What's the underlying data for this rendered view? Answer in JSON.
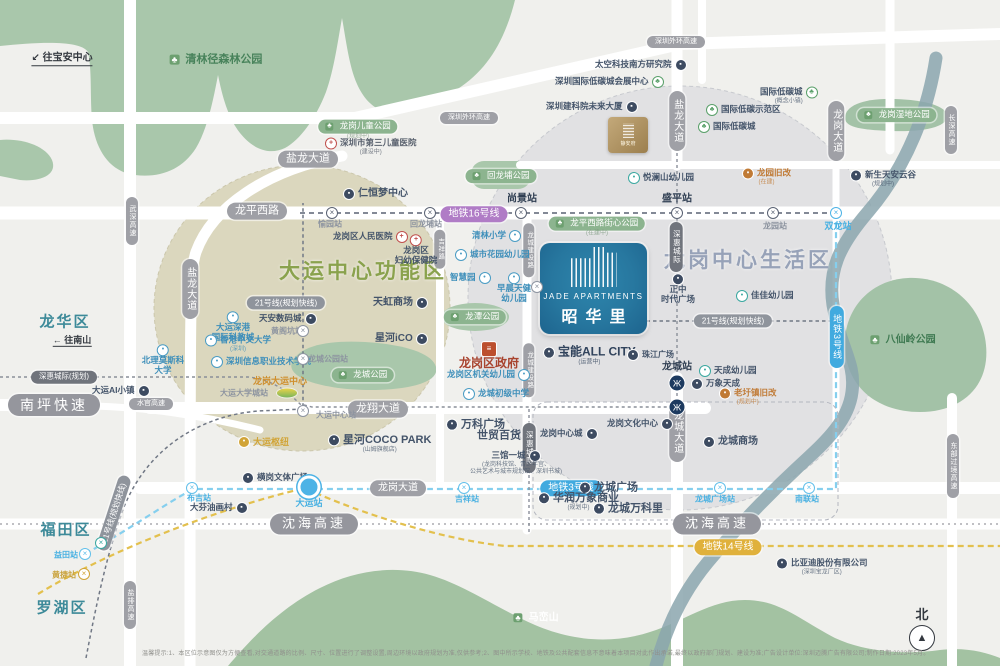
{
  "project": {
    "en": "JADE APARTMENTS",
    "cn": "昭华里",
    "sister": "静安府"
  },
  "compass": {
    "label": "北"
  },
  "disclaimer": {
    "text": "温馨提示:1、本区位示意图仅为方便查看,对交通道路的比例、尺寸、位置进行了调整设置,周边环境以政府规划为准,仅供参考;2、图中所示学校、地铁及公共配套信息不意味着本项目对此作出承诺,最终以政府部门规划、建设为准;广告设计单位:深圳迈腾广告有限公司;制作日期:2023年5月。"
  },
  "zones": [
    {
      "t": "大运中心功能区",
      "x": 363,
      "y": 272,
      "c": "#8aa24d",
      "fs": 21
    },
    {
      "t": "龙岗中心生活区",
      "x": 748,
      "y": 261,
      "c": "#97a2b8",
      "fs": 21
    }
  ],
  "districts": [
    {
      "t": "龙华区",
      "x": 65,
      "y": 322,
      "fs": 15
    },
    {
      "t": "福田区",
      "x": 66,
      "y": 530,
      "fs": 15
    },
    {
      "t": "罗湖区",
      "x": 62,
      "y": 608,
      "fs": 15
    }
  ],
  "arrows": [
    {
      "t": "↙ 往宝安中心",
      "x": 62,
      "y": 59,
      "fs": 10
    },
    {
      "t": "← 往南山",
      "x": 72,
      "y": 341,
      "fs": 9
    }
  ],
  "road_badges": [
    {
      "t": "盐龙大道",
      "x": 308,
      "y": 159,
      "fs": 11
    },
    {
      "t": "龙平西路",
      "x": 257,
      "y": 211,
      "fs": 11
    },
    {
      "t": "深圳外环高速",
      "x": 469,
      "y": 118,
      "fs": 7
    },
    {
      "t": "深圳外环高速",
      "x": 676,
      "y": 42,
      "fs": 7
    },
    {
      "t": "龙翔大道",
      "x": 378,
      "y": 409,
      "fs": 11
    },
    {
      "t": "龙岗大道",
      "x": 398,
      "y": 488,
      "fs": 10
    },
    {
      "t": "南坪快速",
      "x": 54,
      "y": 405,
      "fs": 14,
      "big": 1
    },
    {
      "t": "水官高速",
      "x": 151,
      "y": 404,
      "fs": 7
    },
    {
      "t": "沈海高速",
      "x": 314,
      "y": 524,
      "fs": 13,
      "big": 1
    },
    {
      "t": "沈海高速",
      "x": 717,
      "y": 524,
      "fs": 13,
      "big": 1
    },
    {
      "t": "武深高速",
      "x": 132,
      "y": 221,
      "fs": 7,
      "vert": 1
    },
    {
      "t": "盐龙大道",
      "x": 190,
      "y": 289,
      "fs": 10,
      "vert": 1
    },
    {
      "t": "盐龙大道",
      "x": 677,
      "y": 121,
      "fs": 10,
      "vert": 1
    },
    {
      "t": "龙岗大道",
      "x": 836,
      "y": 131,
      "fs": 10,
      "vert": 1
    },
    {
      "t": "长深高速",
      "x": 951,
      "y": 130,
      "fs": 7,
      "vert": 1
    },
    {
      "t": "盐排高速",
      "x": 130,
      "y": 605,
      "fs": 7,
      "vert": 1
    },
    {
      "t": "东部过境高速",
      "x": 953,
      "y": 466,
      "fs": 7,
      "vert": 1
    },
    {
      "t": "龙城大道",
      "x": 677,
      "y": 432,
      "fs": 10,
      "vert": 1
    },
    {
      "t": "龙城建设路",
      "x": 529,
      "y": 250,
      "fs": 6.5,
      "vert": 1
    },
    {
      "t": "龙城建设路",
      "x": 529,
      "y": 370,
      "fs": 6.5,
      "vert": 1
    },
    {
      "t": "吉祥路",
      "x": 440,
      "y": 249,
      "fs": 6.5,
      "vert": 1
    }
  ],
  "metro_badges": [
    {
      "t": "地铁16号线",
      "x": 474,
      "y": 214,
      "bg": "#b07cc6",
      "fs": 10
    },
    {
      "t": "地铁3号线",
      "x": 571,
      "y": 488,
      "bg": "#41aadf",
      "fs": 10
    },
    {
      "t": "地铁3号线",
      "x": 837,
      "y": 337,
      "bg": "#41aadf",
      "fs": 9,
      "vert": 1
    },
    {
      "t": "地铁14号线",
      "x": 728,
      "y": 547,
      "bg": "#e0b13c",
      "fs": 10
    },
    {
      "t": "21号线(规划快线)",
      "x": 286,
      "y": 303,
      "bg": "#8f949c",
      "fs": 8
    },
    {
      "t": "21号线(规划快线)",
      "x": 733,
      "y": 321,
      "bg": "#8f949c",
      "fs": 8
    },
    {
      "t": "21号线(规划快线)",
      "x": 114,
      "y": 513,
      "bg": "#8f949c",
      "fs": 8,
      "rot": -72
    },
    {
      "t": "深惠城际(规划)",
      "x": 64,
      "y": 377,
      "bg": "#70747c",
      "fs": 7.5
    },
    {
      "t": "深惠城际",
      "x": 676,
      "y": 247,
      "bg": "#70747c",
      "fs": 7.5,
      "vert": 1
    },
    {
      "t": "深惠城际",
      "x": 529,
      "y": 448,
      "bg": "#70747c",
      "fs": 7.5,
      "vert": 1
    }
  ],
  "park_pills": [
    {
      "t": "龙岗儿童公园",
      "x": 358,
      "y": 130,
      "sub": "(规划中)"
    },
    {
      "t": "回龙埔公园",
      "x": 501,
      "y": 176
    },
    {
      "t": "龙平西路街心公园",
      "x": 597,
      "y": 227,
      "sub": "(在建中)"
    },
    {
      "t": "龙潭公园",
      "x": 475,
      "y": 317
    },
    {
      "t": "龙城公园",
      "x": 363,
      "y": 375
    },
    {
      "t": "龙岗湿地公园",
      "x": 897,
      "y": 115
    }
  ],
  "park_texts": [
    {
      "t": "清林径森林公园",
      "x": 216,
      "y": 60,
      "c": "#47825a",
      "fs": 11
    },
    {
      "t": "八仙岭公园",
      "x": 903,
      "y": 340,
      "c": "#3f7a52",
      "fs": 10
    },
    {
      "t": "马峦山",
      "x": 536,
      "y": 618,
      "c": "#ffffff",
      "fs": 10
    }
  ],
  "pois": [
    {
      "t": "太空科技南方研究院",
      "x": 595,
      "y": 65,
      "ic": "biz",
      "side": "r"
    },
    {
      "t": "深圳国际低碳城会展中心",
      "x": 555,
      "y": 82,
      "ic": "eco",
      "side": "r"
    },
    {
      "t": "深圳建科院未来大厦",
      "x": 546,
      "y": 107,
      "ic": "biz",
      "side": "r"
    },
    {
      "t": "国际低碳城",
      "x": 760,
      "y": 96,
      "ic": "eco",
      "side": "r",
      "sub": "(概念小镇)"
    },
    {
      "t": "国际低碳示范区",
      "x": 706,
      "y": 110,
      "ic": "eco"
    },
    {
      "t": "国际低碳城",
      "x": 698,
      "y": 127,
      "ic": "eco"
    },
    {
      "t": "新生天安云谷",
      "x": 850,
      "y": 179,
      "ic": "biz",
      "sub": "(规划中)"
    },
    {
      "t": "悦澜山幼儿园",
      "x": 628,
      "y": 178,
      "ic": "kid"
    },
    {
      "t": "龙园旧改",
      "x": 742,
      "y": 177,
      "ic": "org",
      "c": "#c07a35",
      "sub": "(在建)"
    },
    {
      "t": "仁恒梦中心",
      "x": 343,
      "y": 194,
      "ic": "biz",
      "fs": 10
    },
    {
      "t": "深圳市第三儿童医院",
      "x": 325,
      "y": 147,
      "ic": "red",
      "c": "#59616e",
      "sub": "(建设中)"
    },
    {
      "t": "龙岗区人民医院",
      "x": 333,
      "y": 237,
      "ic": "red",
      "side": "r"
    },
    {
      "t": "龙岗区妇幼保健院",
      "x": 416,
      "y": 250,
      "ic": "red",
      "stack": [
        "龙岗区",
        "妇幼保健院"
      ]
    },
    {
      "t": "清林小学",
      "x": 472,
      "y": 236,
      "ic": "edu",
      "side": "r",
      "c": "#3e8fba"
    },
    {
      "t": "城市花园幼儿园",
      "x": 455,
      "y": 255,
      "ic": "edu",
      "c": "#3e8fba"
    },
    {
      "t": "智慧园",
      "x": 450,
      "y": 278,
      "ic": "edu",
      "side": "r",
      "c": "#3e8fba"
    },
    {
      "t": "早晨天健幼儿园",
      "x": 514,
      "y": 288,
      "ic": "edu",
      "c": "#3e8fba",
      "stack": [
        "早晨天健",
        "幼儿园"
      ]
    },
    {
      "t": "天虹商场",
      "x": 373,
      "y": 303,
      "ic": "biz",
      "side": "r",
      "fs": 10
    },
    {
      "t": "星河iCO",
      "x": 375,
      "y": 339,
      "ic": "biz",
      "side": "r",
      "fs": 10
    },
    {
      "t": "龙岗区政府",
      "x": 489,
      "y": 356,
      "ic": "gov",
      "c": "#a8432e",
      "fs": 12,
      "fw": 700,
      "stack": [
        "龙岗区政府"
      ]
    },
    {
      "t": "龙岗区机关幼儿园",
      "x": 447,
      "y": 375,
      "ic": "edu",
      "side": "r",
      "c": "#3e8fba"
    },
    {
      "t": "龙城初级中学",
      "x": 463,
      "y": 394,
      "ic": "edu",
      "c": "#3e8fba"
    },
    {
      "t": "大运深港国际科教城",
      "x": 233,
      "y": 327,
      "ic": "edu",
      "c": "#3e8fba",
      "stack": [
        "大运深港",
        "国际科教城"
      ]
    },
    {
      "t": "天安数码城",
      "x": 259,
      "y": 319,
      "ic": "biz",
      "side": "r"
    },
    {
      "t": "香港中文大学",
      "x": 205,
      "y": 344,
      "ic": "edu",
      "c": "#3e8fba",
      "sub": "(深圳)"
    },
    {
      "t": "深圳信息职业技术学院",
      "x": 211,
      "y": 362,
      "ic": "edu",
      "c": "#3e8fba"
    },
    {
      "t": "北理莫斯科大学",
      "x": 163,
      "y": 360,
      "ic": "edu",
      "c": "#3e8fba",
      "stack": [
        "北理莫斯科",
        "大学"
      ]
    },
    {
      "t": "龙岗大运中心",
      "x": 253,
      "y": 381,
      "c": "#cf8f2e",
      "fs": 9,
      "fw": 700
    },
    {
      "t": "大运AI小镇",
      "x": 92,
      "y": 391,
      "ic": "biz",
      "side": "r"
    },
    {
      "t": "大运枢纽",
      "x": 238,
      "y": 442,
      "ic": "gold",
      "c": "#d1a437",
      "fs": 9,
      "fw": 700
    },
    {
      "t": "横岗文体广场",
      "x": 242,
      "y": 478,
      "ic": "biz"
    },
    {
      "t": "大芬油画村",
      "x": 190,
      "y": 508,
      "ic": "biz",
      "side": "r"
    },
    {
      "t": "星河COCO PARK",
      "x": 328,
      "y": 444,
      "ic": "biz",
      "fs": 11,
      "fw": 700,
      "sub": "(山姆旗舰店)"
    },
    {
      "t": "万科广场",
      "x": 446,
      "y": 425,
      "ic": "biz",
      "fs": 11,
      "fw": 700
    },
    {
      "t": "世贸百货",
      "x": 477,
      "y": 436,
      "fs": 11,
      "fw": 700
    },
    {
      "t": "三馆一城",
      "x": 470,
      "y": 463,
      "ic": "biz",
      "side": "r",
      "sub": "(龙岗科技馆、青少年宫、",
      "sub2": "公共艺术与城市规划馆、深圳书城)"
    },
    {
      "t": "宝能ALL CITY",
      "x": 543,
      "y": 356,
      "ic": "biz",
      "fs": 12,
      "fw": 700,
      "c": "#31435c",
      "sub": "(运营中)"
    },
    {
      "t": "珠江广场",
      "x": 627,
      "y": 355,
      "ic": "biz",
      "fs": 8
    },
    {
      "t": "正中时代广场",
      "x": 678,
      "y": 289,
      "ic": "biz",
      "stack": [
        "正中",
        "时代广场"
      ]
    },
    {
      "t": "佳佳幼儿园",
      "x": 736,
      "y": 296,
      "ic": "kid"
    },
    {
      "t": "天成幼儿园",
      "x": 699,
      "y": 371,
      "ic": "kid"
    },
    {
      "t": "万象天成",
      "x": 691,
      "y": 384,
      "ic": "biz"
    },
    {
      "t": "老圩镇旧改",
      "x": 719,
      "y": 397,
      "ic": "org",
      "c": "#c07a35",
      "sub": "(规划中)"
    },
    {
      "t": "龙岗中心城",
      "x": 540,
      "y": 434,
      "ic": "biz",
      "side": "r"
    },
    {
      "t": "龙城广场",
      "x": 579,
      "y": 488,
      "ic": "biz",
      "fs": 11,
      "fw": 700
    },
    {
      "t": "龙城万科里",
      "x": 593,
      "y": 509,
      "ic": "biz",
      "fs": 11,
      "fw": 700
    },
    {
      "t": "华润万象商业",
      "x": 538,
      "y": 502,
      "ic": "biz",
      "fs": 11,
      "fw": 700,
      "sub": "(规划中)"
    },
    {
      "t": "龙岗文化中心",
      "x": 607,
      "y": 424,
      "ic": "biz",
      "side": "r"
    },
    {
      "t": "龙城商场",
      "x": 703,
      "y": 442,
      "ic": "biz",
      "fs": 10,
      "fw": 700
    },
    {
      "t": "比亚迪股份有限公司",
      "x": 776,
      "y": 567,
      "ic": "biz",
      "sub": "(深圳宝龙厂区)"
    }
  ],
  "stations": [
    {
      "t": "尚景站",
      "x": 522,
      "y": 199,
      "c": "#2f3e52",
      "fw": 700,
      "fs": 10
    },
    {
      "t": "盛平站",
      "x": 677,
      "y": 199,
      "c": "#2f3e52",
      "fw": 700,
      "fs": 10
    },
    {
      "t": "龙城站",
      "x": 677,
      "y": 367,
      "c": "#2f3e52",
      "fw": 700,
      "fs": 10
    },
    {
      "t": "回龙埔站",
      "x": 426,
      "y": 224,
      "c": "#8d94a0",
      "fs": 8
    },
    {
      "t": "愉园站",
      "x": 330,
      "y": 224,
      "c": "#8d94a0",
      "fs": 8
    },
    {
      "t": "龙园站",
      "x": 775,
      "y": 226,
      "c": "#8d94a0",
      "fs": 8
    },
    {
      "t": "双龙站",
      "x": 838,
      "y": 226,
      "c": "#49b1e2",
      "fs": 9
    },
    {
      "t": "布吉站",
      "x": 199,
      "y": 498,
      "c": "#49b1e2",
      "fs": 8
    },
    {
      "t": "大运站",
      "x": 309,
      "y": 503,
      "c": "#49b1e2",
      "fs": 9
    },
    {
      "t": "吉祥站",
      "x": 467,
      "y": 499,
      "c": "#49b1e2",
      "fs": 8
    },
    {
      "t": "龙城广场站",
      "x": 715,
      "y": 499,
      "c": "#49b1e2",
      "fs": 8
    },
    {
      "t": "南联站",
      "x": 807,
      "y": 499,
      "c": "#49b1e2",
      "fs": 8
    },
    {
      "t": "黄阁坑站",
      "x": 287,
      "y": 331,
      "c": "#8d94a0",
      "fs": 8
    },
    {
      "t": "龙城公园站",
      "x": 328,
      "y": 359,
      "c": "#8d94a0",
      "fs": 8
    },
    {
      "t": "大运中心站",
      "x": 336,
      "y": 415,
      "c": "#8d94a0",
      "fs": 8
    },
    {
      "t": "大运大学城站",
      "x": 244,
      "y": 393,
      "c": "#8d94a0",
      "fs": 8
    },
    {
      "t": "益田站",
      "x": 66,
      "y": 555,
      "c": "#49b1e2",
      "fs": 8
    },
    {
      "t": "黄捷站",
      "x": 64,
      "y": 575,
      "c": "#c9a23c",
      "fs": 8
    }
  ],
  "markers": [
    {
      "x": 332,
      "y": 213,
      "k": "x",
      "c": "#5a6273"
    },
    {
      "x": 430,
      "y": 213,
      "k": "x",
      "c": "#5a6273"
    },
    {
      "x": 521,
      "y": 213,
      "k": "x",
      "c": "#5a6273"
    },
    {
      "x": 677,
      "y": 213,
      "k": "x",
      "c": "#5a6273"
    },
    {
      "x": 773,
      "y": 213,
      "k": "x",
      "c": "#5a6273"
    },
    {
      "x": 836,
      "y": 213,
      "k": "x",
      "c": "#4db3e6"
    },
    {
      "x": 192,
      "y": 488,
      "k": "x",
      "c": "#63c0ea"
    },
    {
      "x": 464,
      "y": 488,
      "k": "x",
      "c": "#63c0ea"
    },
    {
      "x": 720,
      "y": 488,
      "k": "x",
      "c": "#63c0ea"
    },
    {
      "x": 809,
      "y": 488,
      "k": "x",
      "c": "#63c0ea"
    },
    {
      "x": 85,
      "y": 554,
      "k": "x",
      "c": "#63c0ea"
    },
    {
      "x": 84,
      "y": 574,
      "k": "x",
      "c": "#d1a437"
    },
    {
      "x": 101,
      "y": 543,
      "k": "x",
      "c": "#3aa8a0"
    },
    {
      "x": 303,
      "y": 331,
      "k": "x",
      "c": "#8d94a0"
    },
    {
      "x": 303,
      "y": 359,
      "k": "x",
      "c": "#8d94a0"
    },
    {
      "x": 303,
      "y": 411,
      "k": "x",
      "c": "#8d94a0"
    },
    {
      "x": 537,
      "y": 287,
      "k": "x",
      "c": "#8d94a0"
    },
    {
      "x": 309,
      "y": 487,
      "k": "big"
    },
    {
      "x": 677,
      "y": 383,
      "k": "mi"
    },
    {
      "x": 677,
      "y": 407,
      "k": "mi"
    }
  ],
  "colors": {
    "metro3": "#85cfee",
    "metro14": "#e3c04d",
    "metro16": "#5a6273",
    "line21": "#717885",
    "rail": "#8a8f99",
    "park": "#a9c7ab",
    "mountain": "#a3c2a2",
    "river": "#8ba6ae",
    "beige_zone": "#d6d1b3",
    "gray_zone": "#d5d6dc"
  }
}
